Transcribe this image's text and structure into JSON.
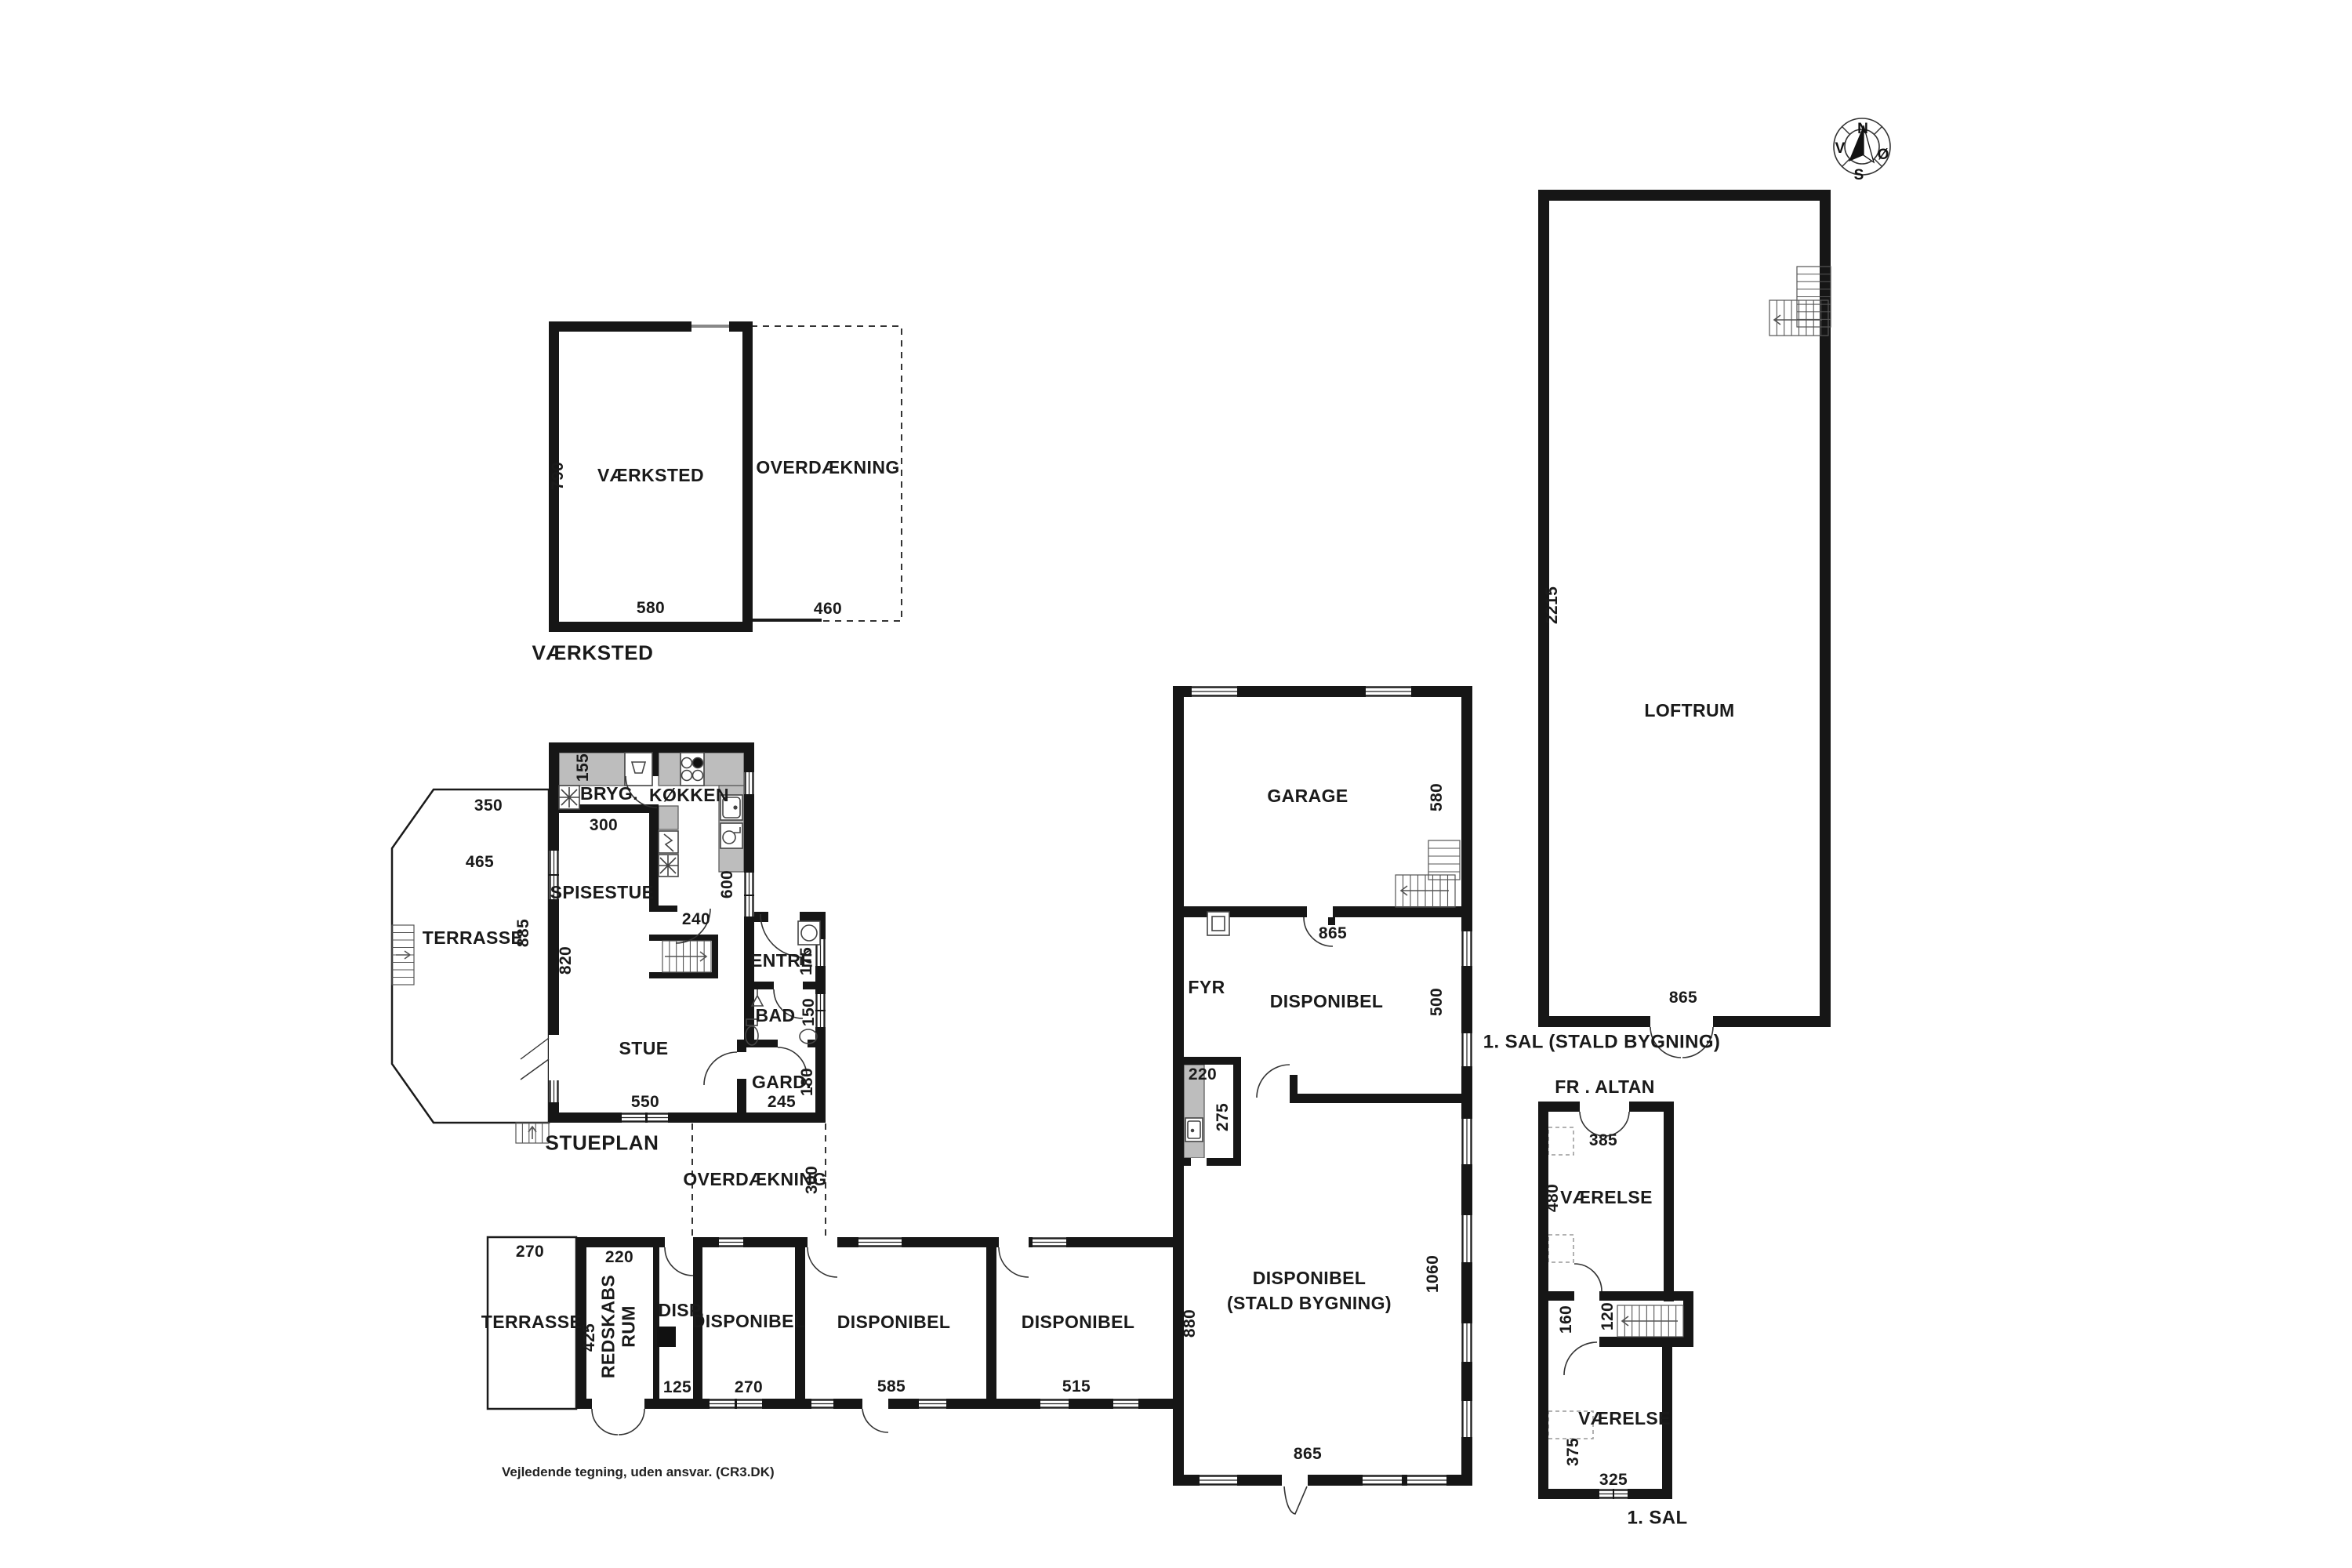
{
  "page": {
    "disclaimer": "Vejledende tegning, uden ansvar. (CR3.DK)"
  },
  "compass": {
    "n": "N",
    "s": "S",
    "v": "V",
    "o": "Ø"
  },
  "workshop": {
    "room": "VÆRKSTED",
    "caption": "VÆRKSTED",
    "dim_height": "790",
    "dim_width": "580",
    "cover": "OVERDÆKNING",
    "cover_width": "460"
  },
  "house": {
    "caption": "STUEPLAN",
    "bryg": "BRYG.",
    "bryg_w": "155",
    "bryg_len": "300",
    "kitchen": "KØKKEN",
    "kitchen_h": "600",
    "kitchen_door": "240",
    "dining": "SPISESTUE",
    "dining_h": "820",
    "living": "STUE",
    "living_w": "550",
    "entre": "ENTRÉ",
    "entre_w": "175",
    "bath": "BAD",
    "bath_w": "150",
    "closet": "GARD.",
    "closet_h": "180",
    "closet_w": "245",
    "terrace": "TERRASSE",
    "terrace_h": "885",
    "terrace_top": "350",
    "terrace_mid": "465",
    "cover": "OVERDÆKNING",
    "cover_w": "300"
  },
  "row": {
    "terrace": "TERRASSE",
    "terrace_w": "270",
    "shed1": "REDSKABS",
    "shed2": "RUM",
    "shed_w": "220",
    "shed_h": "425",
    "disp0": "DISP.",
    "disp0_w": "125",
    "disp1": "DISPONIBEL",
    "disp1_w": "270",
    "disp2": "DISPONIBEL",
    "disp2_w": "585",
    "disp3": "DISPONIBEL",
    "disp3_w": "515",
    "row_h": "880"
  },
  "stald": {
    "garage": "GARAGE",
    "garage_h": "580",
    "garage_door": "865",
    "fyr": "FYR",
    "disp": "DISPONIBEL",
    "disp_h": "500",
    "kitch_w": "220",
    "kitch_h": "275",
    "hall1": "DISPONIBEL",
    "hall2": "(STALD BYGNING)",
    "hall_h": "1060",
    "hall_w": "865"
  },
  "loft": {
    "room": "LOFTRUM",
    "dim_h": "2215",
    "dim_door": "865",
    "caption": "1. SAL (STALD BYGNING)"
  },
  "sal": {
    "altan": "FR . ALTAN",
    "room1": "VÆRELSE",
    "room1_w": "385",
    "room1_h": "480",
    "hall_h": "160",
    "stair_w": "120",
    "room2": "VÆRELSE",
    "room2_w": "325",
    "room2_h": "375",
    "caption": "1. SAL"
  }
}
